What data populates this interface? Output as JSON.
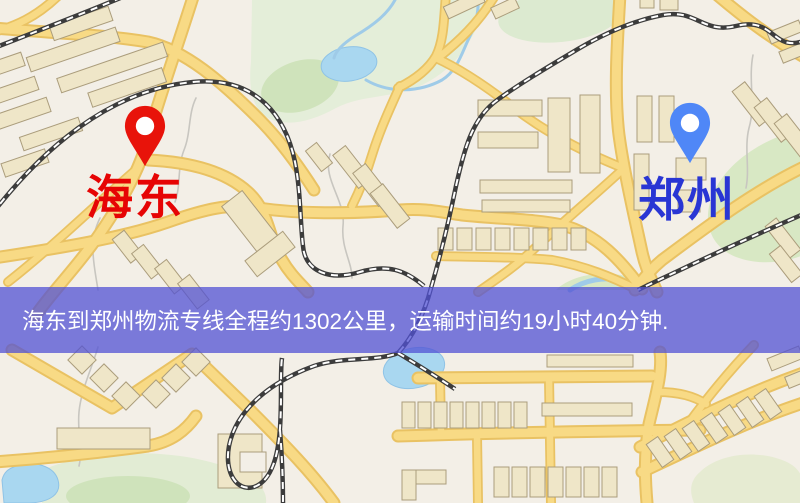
{
  "banner": {
    "text": "海东到郑州物流专线全程约1302公里，运输时间约19小时40分钟.",
    "bg_color": "rgba(82,82,212,0.75)",
    "text_color": "#ffffff"
  },
  "markers": {
    "origin": {
      "label": "海东",
      "pin_color": "#e8130a",
      "label_color": "#e60404"
    },
    "destination": {
      "label": "郑州",
      "pin_color": "#4f87f7",
      "label_color": "#2936d4"
    }
  },
  "map_colors": {
    "background": "#f3efe7",
    "road_fill": "#f8da85",
    "road_casing": "#e9c263",
    "railway": "#3c3c3c",
    "water": "#a9d7f0",
    "park": "#dcead0",
    "building": "#efe6c8",
    "building_outline": "#ab9d7c"
  }
}
